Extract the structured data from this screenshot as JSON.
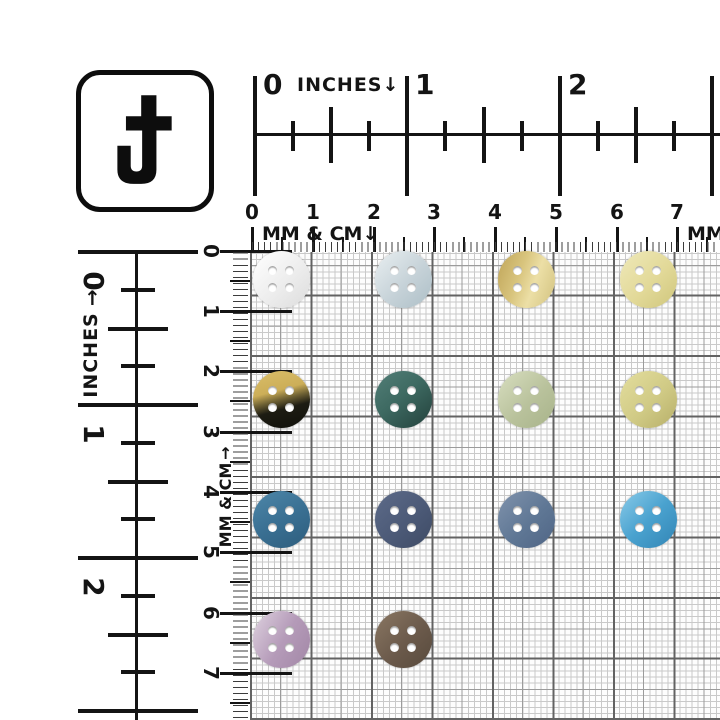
{
  "logo": {
    "letter": "J"
  },
  "rulers": {
    "top_inches": {
      "label": "INCHES↓",
      "numbers": [
        "0",
        "1",
        "2"
      ]
    },
    "top_cm": {
      "label": "MM & CM↓",
      "right_label": "MM",
      "numbers": [
        "0",
        "1",
        "2",
        "3",
        "4",
        "5",
        "6",
        "7"
      ]
    },
    "left_inches": {
      "label": "INCHES",
      "arrow": "↑",
      "numbers": [
        "0",
        "1",
        "2"
      ]
    },
    "left_cm": {
      "label": "MM & CM",
      "arrow": "↑",
      "numbers": [
        "0",
        "1",
        "2",
        "3",
        "4",
        "5",
        "6",
        "7"
      ]
    }
  },
  "grid": {
    "background": "#fdfdfd",
    "line_colors": {
      "fine_1mm": "#c9c9c9",
      "medium_5mm": "#9b9b9b",
      "major_1cm": "#636363",
      "ruler_dash": "#3c3c3c"
    }
  },
  "buttons": {
    "hole_count": 4,
    "items": [
      {
        "name": "white-pearl",
        "row": 0,
        "col": 0,
        "angle": 135,
        "stops": [
          [
            "#ffffff",
            "0%"
          ],
          [
            "#ededed",
            "55%"
          ],
          [
            "#dcdcdc",
            "100%"
          ]
        ]
      },
      {
        "name": "pale-blue-gray",
        "row": 0,
        "col": 1,
        "angle": 135,
        "stops": [
          [
            "#e9eff1",
            "0%"
          ],
          [
            "#c6d2d8",
            "55%"
          ],
          [
            "#adbfc7",
            "100%"
          ]
        ]
      },
      {
        "name": "antique-gold",
        "row": 0,
        "col": 2,
        "angle": 110,
        "stops": [
          [
            "#bfa458",
            "0%"
          ],
          [
            "#d8c47d",
            "38%"
          ],
          [
            "#ecdfa6",
            "62%"
          ],
          [
            "#d2c27f",
            "100%"
          ]
        ]
      },
      {
        "name": "pale-cream",
        "row": 0,
        "col": 3,
        "angle": 135,
        "stops": [
          [
            "#efe9ba",
            "0%"
          ],
          [
            "#e2d998",
            "55%"
          ],
          [
            "#cfc67c",
            "100%"
          ]
        ]
      },
      {
        "name": "gold-black",
        "row": 1,
        "col": 0,
        "angle": 165,
        "stops": [
          [
            "#dabe69",
            "0%"
          ],
          [
            "#ccae58",
            "36%"
          ],
          [
            "#6e6134",
            "50%"
          ],
          [
            "#1d1c13",
            "64%"
          ],
          [
            "#10100a",
            "100%"
          ]
        ]
      },
      {
        "name": "dark-teal",
        "row": 1,
        "col": 1,
        "angle": 140,
        "stops": [
          [
            "#527e77",
            "0%"
          ],
          [
            "#3e6a62",
            "45%"
          ],
          [
            "#2a4c46",
            "85%"
          ],
          [
            "#23403b",
            "100%"
          ]
        ]
      },
      {
        "name": "sage-green",
        "row": 1,
        "col": 2,
        "angle": 135,
        "stops": [
          [
            "#d8dec0",
            "0%"
          ],
          [
            "#b9c29c",
            "55%"
          ],
          [
            "#a8b38a",
            "100%"
          ]
        ]
      },
      {
        "name": "khaki-yellow",
        "row": 1,
        "col": 3,
        "angle": 135,
        "stops": [
          [
            "#e4de9e",
            "0%"
          ],
          [
            "#d0ca85",
            "55%"
          ],
          [
            "#b7af69",
            "100%"
          ]
        ]
      },
      {
        "name": "steel-blue",
        "row": 2,
        "col": 0,
        "angle": 150,
        "stops": [
          [
            "#4e87a9",
            "0%"
          ],
          [
            "#3a7093",
            "50%"
          ],
          [
            "#2d5d7d",
            "100%"
          ]
        ]
      },
      {
        "name": "slate-navy",
        "row": 2,
        "col": 1,
        "angle": 135,
        "stops": [
          [
            "#5d6b89",
            "0%"
          ],
          [
            "#4c5a77",
            "55%"
          ],
          [
            "#3e4b65",
            "100%"
          ]
        ]
      },
      {
        "name": "dusty-blue",
        "row": 2,
        "col": 2,
        "angle": 135,
        "stops": [
          [
            "#8093ac",
            "0%"
          ],
          [
            "#5f7795",
            "55%"
          ],
          [
            "#4f6585",
            "100%"
          ]
        ]
      },
      {
        "name": "azure-blue",
        "row": 2,
        "col": 3,
        "angle": 135,
        "stops": [
          [
            "#8acbe9",
            "0%"
          ],
          [
            "#4aa2cf",
            "50%"
          ],
          [
            "#3285b5",
            "100%"
          ]
        ]
      },
      {
        "name": "lavender-mauve",
        "row": 3,
        "col": 0,
        "angle": 120,
        "stops": [
          [
            "#ded2df",
            "0%"
          ],
          [
            "#b59bb9",
            "52%"
          ],
          [
            "#a287a6",
            "100%"
          ]
        ]
      },
      {
        "name": "taupe-brown",
        "row": 3,
        "col": 1,
        "angle": 135,
        "stops": [
          [
            "#8a7763",
            "0%"
          ],
          [
            "#6b5a4b",
            "55%"
          ],
          [
            "#584a3d",
            "100%"
          ]
        ]
      }
    ]
  }
}
